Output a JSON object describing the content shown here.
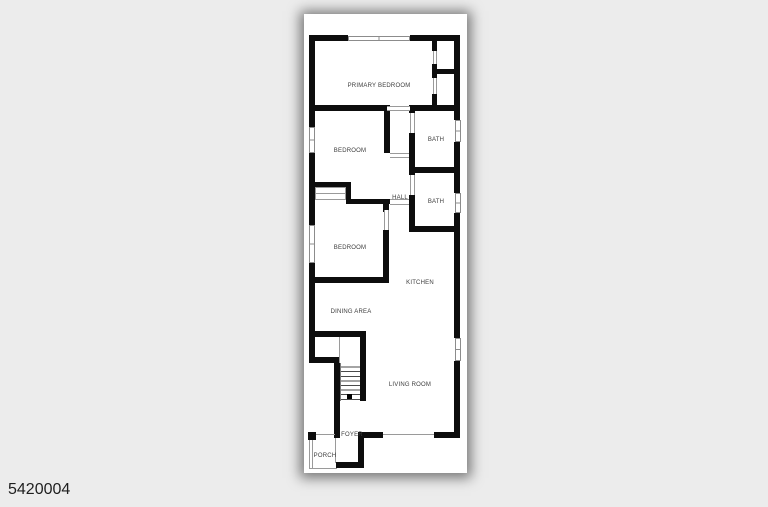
{
  "photo_id": "5420004",
  "colors": {
    "background": "#ececec",
    "page": "#ffffff",
    "wall": "#0d0d0d",
    "label_text": "#3d3d3d",
    "thin_line": "#9a9a9a"
  },
  "plan": {
    "page": [
      304,
      14,
      163,
      459
    ],
    "rooms": [
      {
        "key": "primary-bedroom",
        "label": "PRIMARY BEDROOM",
        "x": 379,
        "y": 86
      },
      {
        "key": "bedroom-1",
        "label": "BEDROOM",
        "x": 350,
        "y": 151
      },
      {
        "key": "bath-1",
        "label": "BATH",
        "x": 436,
        "y": 140
      },
      {
        "key": "hall",
        "label": "HALL",
        "x": 400,
        "y": 198
      },
      {
        "key": "bath-2",
        "label": "BATH",
        "x": 436,
        "y": 202
      },
      {
        "key": "bedroom-2",
        "label": "BEDROOM",
        "x": 350,
        "y": 248
      },
      {
        "key": "kitchen",
        "label": "KITCHEN",
        "x": 420,
        "y": 283
      },
      {
        "key": "dining-area",
        "label": "DINING AREA",
        "x": 351,
        "y": 312
      },
      {
        "key": "living-room",
        "label": "LIVING ROOM",
        "x": 410,
        "y": 385
      },
      {
        "key": "foyer",
        "label": "FOYER",
        "x": 352,
        "y": 435
      },
      {
        "key": "porch",
        "label": "PORCH",
        "x": 325,
        "y": 456
      }
    ],
    "walls": [
      [
        309,
        35,
        39,
        6
      ],
      [
        410,
        35,
        50,
        6
      ],
      [
        309,
        35,
        6,
        92
      ],
      [
        309,
        153,
        6,
        72
      ],
      [
        309,
        263,
        6,
        74
      ],
      [
        454,
        35,
        6,
        85
      ],
      [
        454,
        142,
        6,
        51
      ],
      [
        454,
        213,
        6,
        125
      ],
      [
        454,
        361,
        6,
        76
      ],
      [
        309,
        331,
        57,
        6
      ],
      [
        309,
        337,
        6,
        22
      ],
      [
        309,
        357,
        31,
        6
      ],
      [
        334,
        357,
        6,
        81
      ],
      [
        360,
        331,
        6,
        70
      ],
      [
        359,
        432,
        24,
        6
      ],
      [
        358,
        432,
        6,
        36
      ],
      [
        336,
        462,
        28,
        6
      ],
      [
        434,
        432,
        26,
        6
      ],
      [
        309,
        105,
        78,
        6
      ],
      [
        410,
        105,
        50,
        6
      ],
      [
        432,
        41,
        5,
        10
      ],
      [
        432,
        64,
        5,
        14
      ],
      [
        432,
        94,
        5,
        11
      ],
      [
        437,
        69,
        17,
        5
      ],
      [
        384,
        105,
        6,
        48
      ],
      [
        409,
        105,
        6,
        8
      ],
      [
        409,
        133,
        6,
        42
      ],
      [
        409,
        195,
        6,
        37
      ],
      [
        409,
        167,
        51,
        6
      ],
      [
        409,
        226,
        51,
        6
      ],
      [
        309,
        182,
        42,
        5
      ],
      [
        346,
        182,
        5,
        22
      ],
      [
        346,
        199,
        44,
        5
      ],
      [
        383,
        204,
        6,
        8
      ],
      [
        383,
        230,
        6,
        52
      ],
      [
        309,
        277,
        80,
        6
      ]
    ],
    "windows": [
      [
        348,
        35.5,
        62,
        5
      ],
      [
        308.5,
        127,
        6,
        26
      ],
      [
        308.5,
        225,
        6,
        38
      ],
      [
        454.5,
        120,
        6,
        22
      ],
      [
        454.5,
        193,
        6,
        20
      ],
      [
        454.5,
        338,
        6,
        23
      ]
    ],
    "openings": [
      [
        387,
        105.5,
        23,
        5
      ],
      [
        390,
        152.5,
        19,
        5.5
      ],
      [
        390,
        199,
        19,
        5.5
      ],
      [
        432.5,
        51,
        4.5,
        13
      ],
      [
        432.5,
        78,
        4.5,
        16
      ],
      [
        409.5,
        113,
        5,
        20
      ],
      [
        409.5,
        175,
        5,
        20
      ],
      [
        383.5,
        210,
        5,
        20
      ],
      [
        308.5,
        439,
        4,
        29
      ]
    ],
    "thin_lines": [
      [
        315,
        433.5,
        20,
        1.2
      ],
      [
        308.5,
        467.5,
        28,
        1.2
      ],
      [
        335,
        438,
        1.2,
        25
      ],
      [
        339,
        337,
        1.2,
        26
      ],
      [
        349.5,
        363,
        1,
        38
      ],
      [
        383,
        433.5,
        51,
        1.2
      ]
    ],
    "stairs": [
      340,
      363,
      20,
      38
    ],
    "stair_dot": [
      347,
      394,
      5,
      5
    ],
    "closet": [
      315,
      187,
      31,
      13
    ],
    "porch_post": [
      307.5,
      431.5,
      8,
      8
    ]
  }
}
